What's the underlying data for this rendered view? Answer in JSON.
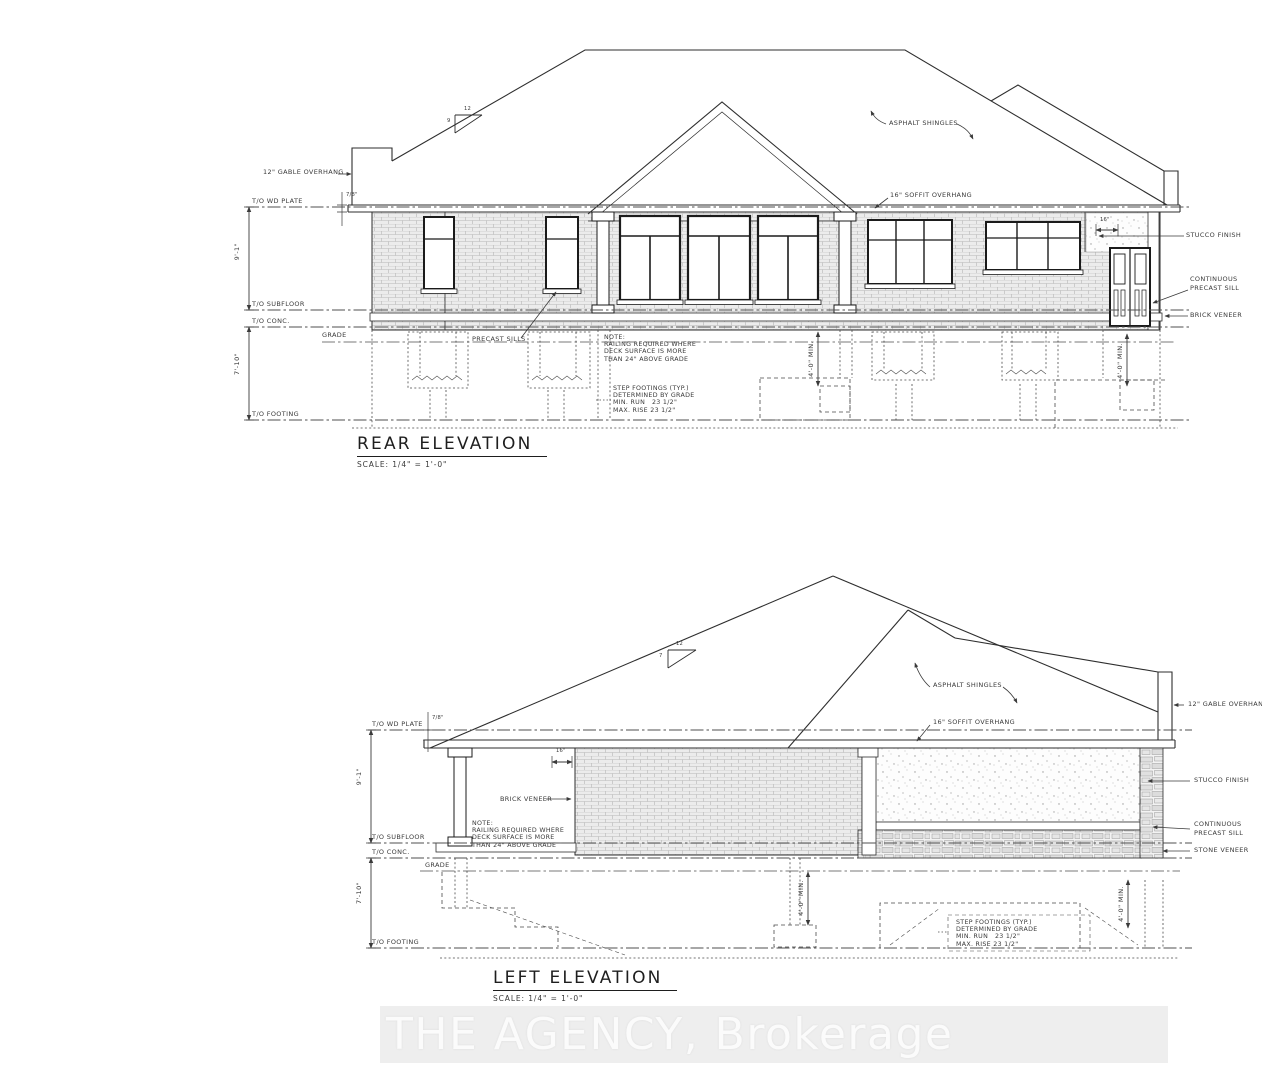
{
  "watermark": "THE AGENCY, Brokerage",
  "rear": {
    "title": "REAR ELEVATION",
    "scale": "SCALE: 1/4\" = 1'-0\"",
    "levels": {
      "plate": "T/O WD PLATE",
      "subfloor": "T/O SUBFLOOR",
      "conc": "T/O CONC.",
      "grade": "GRADE",
      "footing": "T/O FOOTING"
    },
    "dims": {
      "wall_height": "9'-1\"",
      "foundation_height": "7'-10\"",
      "min_footing_depth": "4'-0\" MIN.",
      "plate_offset": "7/8\"",
      "stucco_width": "16\"",
      "pitch_run": "12",
      "pitch_rise": "9"
    },
    "callouts": {
      "gable_overhang": "12\" GABLE OVERHANG",
      "asphalt_shingles": "ASPHALT SHINGLES",
      "soffit_overhang": "16\" SOFFIT OVERHANG",
      "stucco_finish": "STUCCO FINISH",
      "precast_sill_1": "CONTINUOUS",
      "precast_sill_2": "PRECAST SILL",
      "brick_veneer": "BRICK VENEER",
      "precast_sills": "PRECAST SILLS"
    },
    "note": [
      "NOTE:",
      "RAILING REQUIRED WHERE",
      "DECK SURFACE IS MORE",
      "THAN 24\" ABOVE GRADE"
    ],
    "step_note": [
      "STEP FOOTINGS (TYP.)",
      "DETERMINED BY GRADE",
      "MIN. RUN   23 1/2\"",
      "MAX. RISE 23 1/2\""
    ]
  },
  "left": {
    "title": "LEFT ELEVATION",
    "scale": "SCALE: 1/4\" = 1'-0\"",
    "levels": {
      "plate": "T/O WD PLATE",
      "subfloor": "T/O SUBFLOOR",
      "conc": "T/O CONC.",
      "grade": "GRADE",
      "footing": "T/O FOOTING"
    },
    "dims": {
      "wall_height": "9'-1\"",
      "foundation_height": "7'-10\"",
      "min_footing_depth": "4'-0\" MIN.",
      "plate_offset": "7/8\"",
      "soffit_depth": "16\"",
      "pitch_run": "12",
      "pitch_rise": "7"
    },
    "callouts": {
      "gable_overhang": "12\" GABLE OVERHANG",
      "asphalt_shingles": "ASPHALT SHINGLES",
      "soffit_overhang": "16\" SOFFIT OVERHANG",
      "stucco_finish": "STUCCO FINISH",
      "precast_sill_1": "CONTINUOUS",
      "precast_sill_2": "PRECAST SILL",
      "stone_veneer": "STONE VENEER",
      "brick_veneer": "BRICK VENEER"
    },
    "note": [
      "NOTE:",
      "RAILING REQUIRED WHERE",
      "DECK SURFACE IS MORE",
      "THAN 24\" ABOVE GRADE"
    ],
    "step_note": [
      "STEP FOOTINGS (TYP.)",
      "DETERMINED BY GRADE",
      "MIN. RUN   23 1/2\"",
      "MAX. RISE 23 1/2\""
    ]
  }
}
